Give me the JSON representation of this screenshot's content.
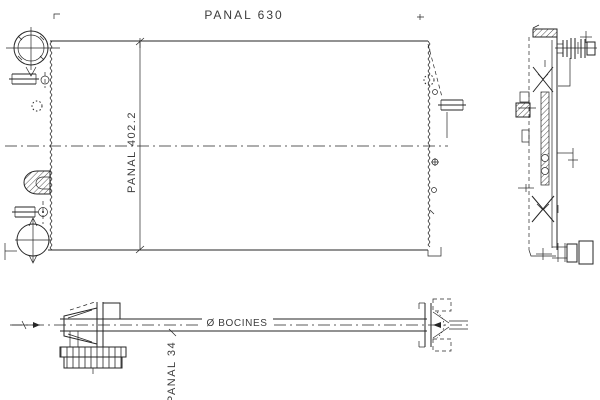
{
  "drawing": {
    "labels": {
      "core_width": "PANAL 630",
      "core_height": "PANAL 402.2",
      "ports_diameter": "Ø BOCINES",
      "core_depth": "PANAL 34"
    },
    "colors": {
      "line": "#262626",
      "text": "#3c3c3c",
      "background": "#ffffff"
    }
  }
}
